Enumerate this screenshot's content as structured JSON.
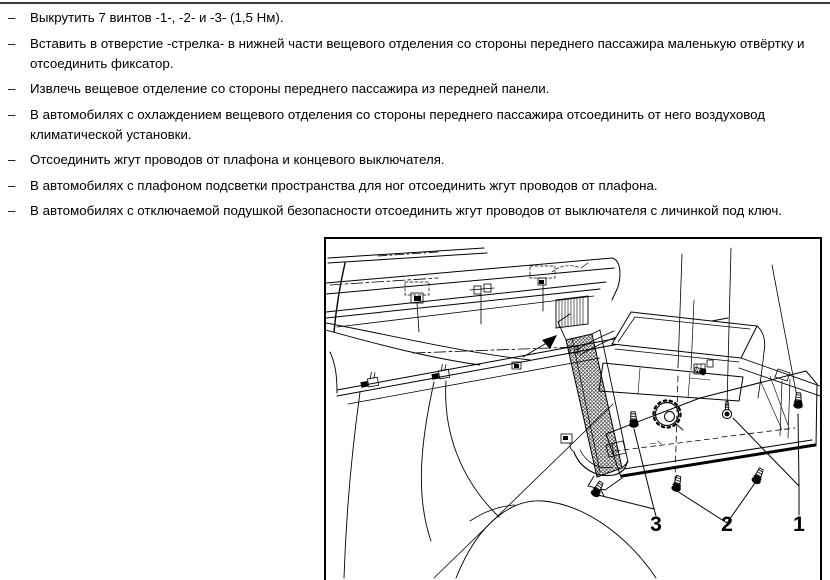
{
  "colors": {
    "ink": "#000000",
    "page_background": "#ffffff",
    "top_rule": "#3c3c3c"
  },
  "instructions": {
    "bullet_char": "–",
    "items": [
      {
        "text": "Выкрутить 7 винтов -1-, -2- и -3- (1,5 Нм)."
      },
      {
        "text": "Вставить в отверстие -стрелка- в нижней части вещевого отделения со стороны переднего пассажира маленькую отвёртку и\nотсоединить фиксатор."
      },
      {
        "text": "Извлечь вещевое отделение со стороны переднего пассажира из передней панели."
      },
      {
        "text": "В автомобилях с охлаждением вещевого отделения со стороны переднего пассажира отсоединить от него воздуховод\nклиматической установки."
      },
      {
        "text": "Отсоединить жгут проводов от плафона и концевого выключателя."
      },
      {
        "text": "В автомобилях с плафоном подсветки пространства для ног отсоединить жгут проводов от плафона."
      },
      {
        "text": "В автомобилях с отключаемой подушкой безопасности отсоединить жгут проводов от выключателя с личинкой под ключ."
      }
    ]
  },
  "figure": {
    "callout_labels": [
      "3",
      "2",
      "1"
    ]
  }
}
